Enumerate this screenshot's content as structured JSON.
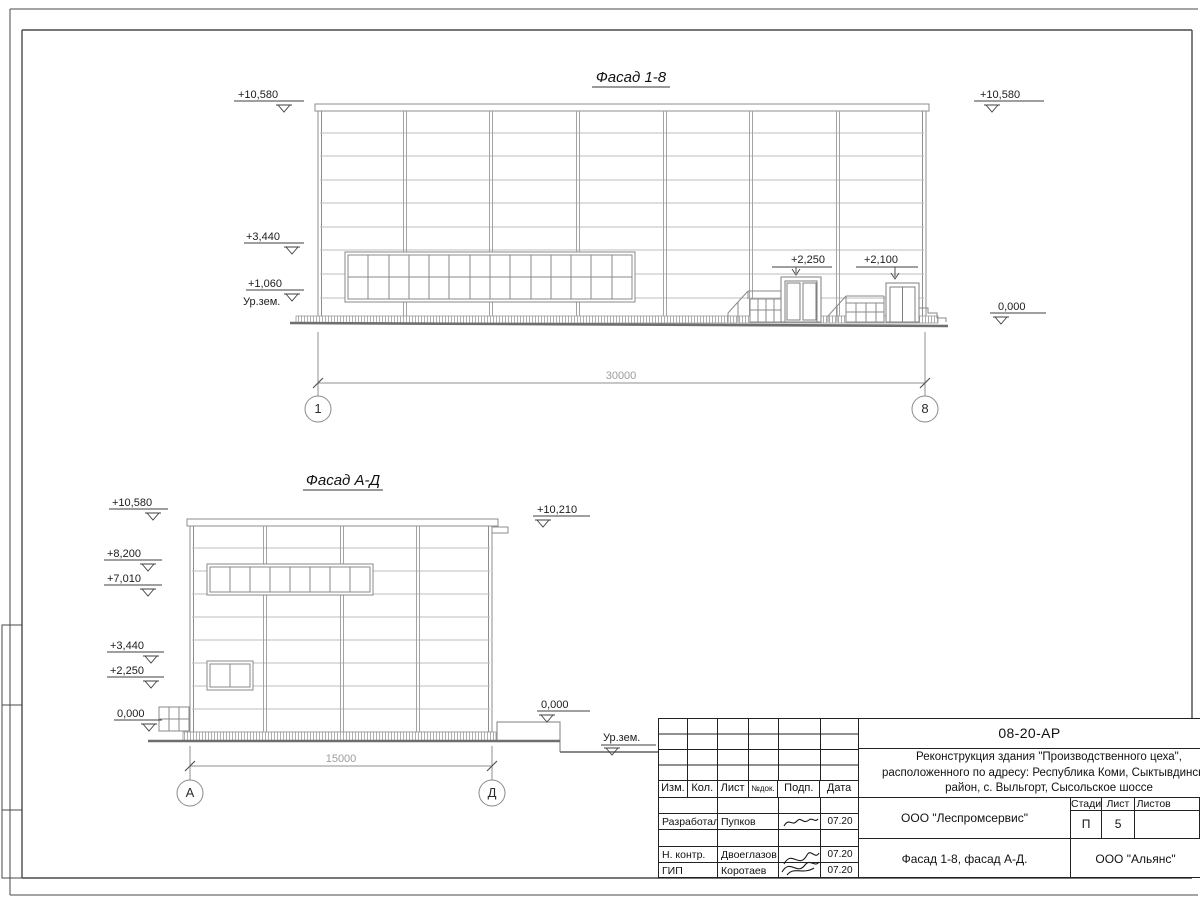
{
  "colors": {
    "line": "#8d8d8d",
    "text": "#1c1c1c",
    "dim_text": "#9c9c9c"
  },
  "drawing": {
    "facade1": {
      "title": "Фасад 1-8",
      "dim": "30000",
      "axisL": "1",
      "axisR": "8",
      "elev": {
        "l1": "+10,580",
        "l2": "+3,440",
        "l3": "+1,060",
        "ground": "Ур.зем.",
        "r1": "+10,580",
        "r2": "0,000",
        "door1": "+2,250",
        "door2": "+2,100"
      }
    },
    "facade2": {
      "title": "Фасад А-Д",
      "dim": "15000",
      "axisL": "А",
      "axisR": "Д",
      "elev": {
        "l1": "+10,580",
        "l2": "+8,200",
        "l3": "+7,010",
        "l4": "+3,440",
        "l5": "+2,250",
        "l6": "0,000",
        "r1": "+10,210",
        "r2": "0,000",
        "ground": "Ур.зем."
      }
    }
  },
  "titleblock": {
    "code": "08-20-АР",
    "desc1": "Реконструкция здания \"Производственного цеха\",",
    "desc2": "расположенного по адресу: Республика Коми, Сыктывдинский",
    "desc3": "район, с. Выльгорт, Сысольское шоссе",
    "cols": {
      "izm": "Изм.",
      "kol": "Кол.",
      "list": "Лист",
      "ndoc": "№док.",
      "podp": "Подп.",
      "data": "Дата"
    },
    "rows": [
      {
        "role": "Разработал",
        "name": "Пупков",
        "date": "07.20"
      },
      {
        "role": "Н. контр.",
        "name": "Двоеглазов",
        "date": "07.20"
      },
      {
        "role": "ГИП",
        "name": "Коротаев",
        "date": "07.20"
      }
    ],
    "stage_label": "Стадия",
    "list_label": "Лист",
    "listov_label": "Листов",
    "stage": "П",
    "list_no": "5",
    "org": "ООО \"Леспромсервис\"",
    "sheet_title": "Фасад 1-8, фасад А-Д.",
    "customer": "ООО \"Альянс\""
  }
}
